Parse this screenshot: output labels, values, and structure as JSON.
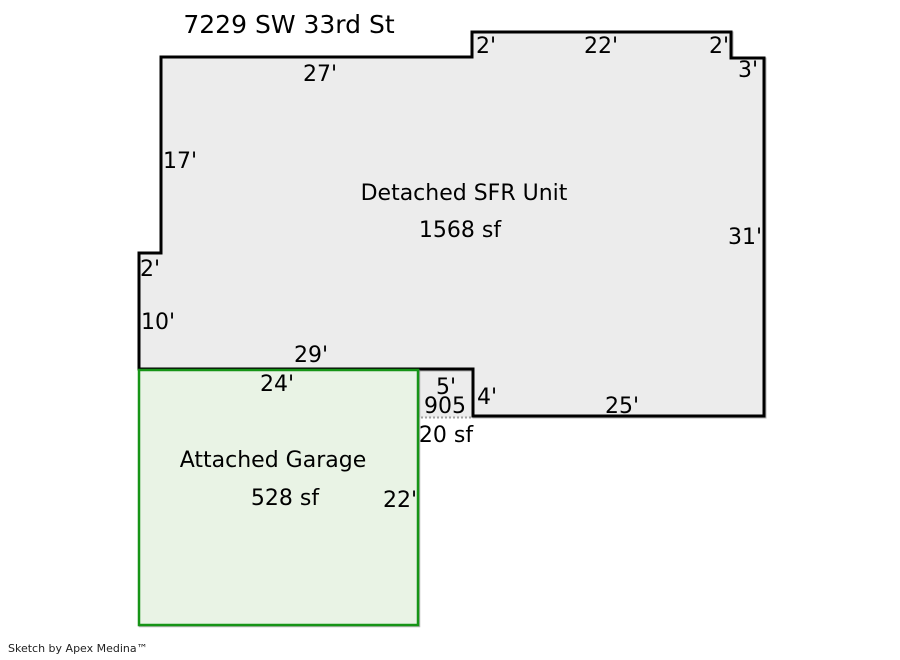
{
  "title": "7229 SW 33rd St",
  "watermark": "Sketch by Apex Medina™",
  "colors": {
    "background": "#ffffff",
    "sfr_fill": "#ececec",
    "sfr_stroke": "#000000",
    "garage_fill": "#e9f3e5",
    "garage_stroke": "#169416",
    "porch_dotted": "#a0a0a0",
    "text": "#000000",
    "watermark_color": "#222222"
  },
  "sfr": {
    "label": "Detached SFR Unit",
    "area": "1568 sf",
    "dims": {
      "top_left": "27'",
      "top_step_up": "2'",
      "top_middle": "22'",
      "top_step_down": "2'",
      "top_right_jog": "3'",
      "right_side": "31'",
      "left_upper": "17'",
      "left_step": "2'",
      "left_lower": "10'",
      "bottom_left": "29'",
      "bottom_right": "25'"
    }
  },
  "garage": {
    "label": "Attached Garage",
    "area": "528 sf",
    "dims": {
      "top": "24'",
      "right": "22'"
    }
  },
  "porch": {
    "number": "905",
    "area": "20 sf",
    "dims": {
      "width": "5'",
      "height": "4'"
    }
  }
}
